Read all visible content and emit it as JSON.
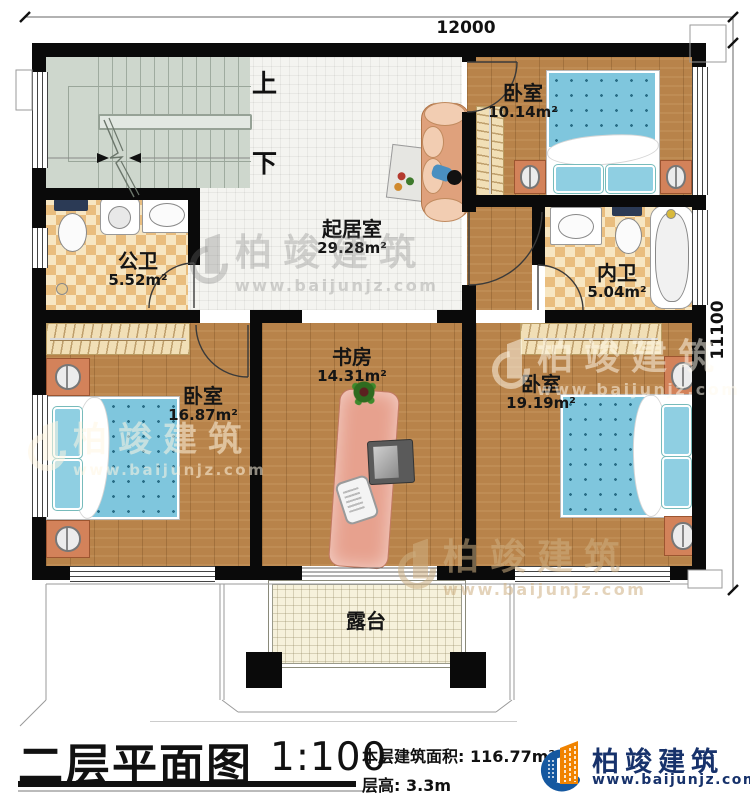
{
  "plan": {
    "dim_top": "12000",
    "dim_right": "11100",
    "stairs_up": "上",
    "stairs_down": "下",
    "rooms": {
      "bedroom_top": {
        "name": "卧室",
        "area": "10.14m²"
      },
      "living": {
        "name": "起居室",
        "area": "29.28m²"
      },
      "public_bath": {
        "name": "公卫",
        "area": "5.52m²"
      },
      "inner_bath": {
        "name": "内卫",
        "area": "5.04m²"
      },
      "bedroom_left": {
        "name": "卧室",
        "area": "16.87m²"
      },
      "study": {
        "name": "书房",
        "area": "14.31m²"
      },
      "bedroom_right": {
        "name": "卧室",
        "area": "19.19m²"
      },
      "terrace": {
        "name": "露台"
      }
    }
  },
  "watermark": {
    "brand": "柏竣建筑",
    "url": "www.baijunjz.com"
  },
  "footer": {
    "title": "二层平面图",
    "scale": "1:100",
    "area_label": "本层建筑面积:",
    "area_value": "116.77m²",
    "height_label": "层高:",
    "height_value": "3.3m",
    "brand": "柏竣建筑",
    "brand_url": "www.baijunjz.com"
  },
  "colors": {
    "wall": "#0a0a0a",
    "bed_blue": "#7fc6dd",
    "logo_blue": "#1558a0",
    "logo_orange": "#f08300"
  }
}
